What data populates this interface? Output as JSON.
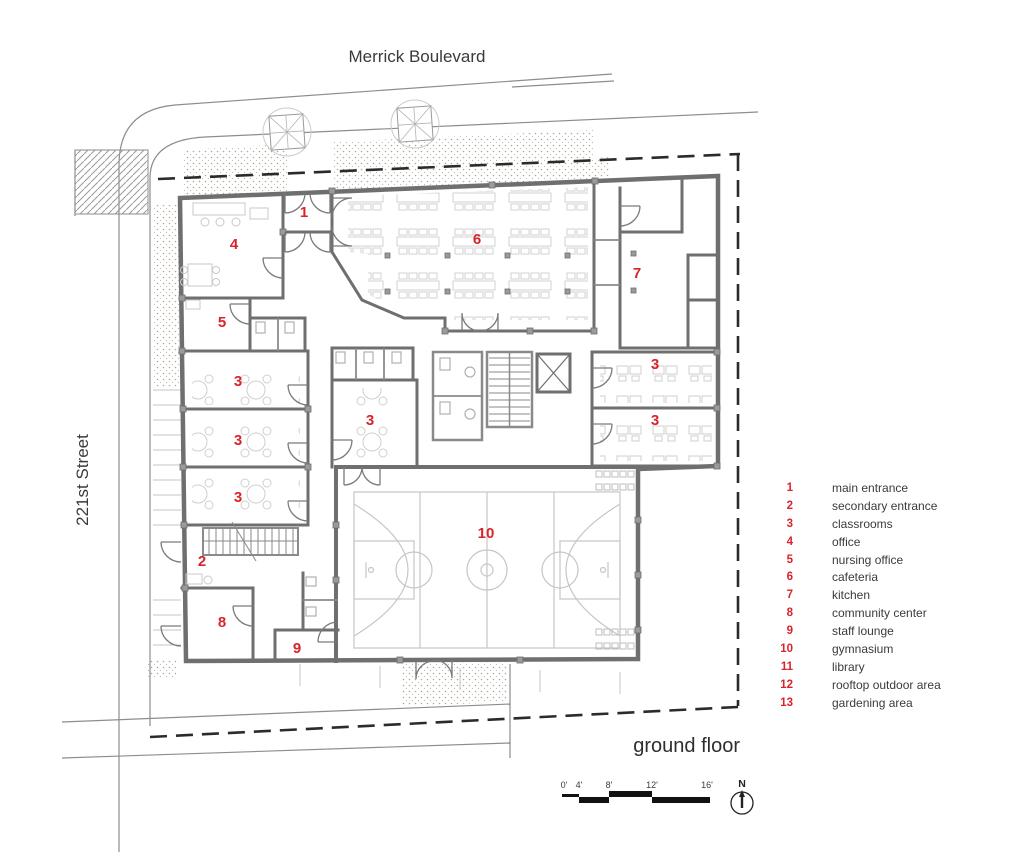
{
  "streets": {
    "top": "Merrick Boulevard",
    "left": "221st Street"
  },
  "title": "ground floor",
  "plan": {
    "labels": [
      {
        "room": "main entrance",
        "num": "1"
      },
      {
        "room": "office",
        "num": "4"
      },
      {
        "room": "nursing office",
        "num": "5"
      },
      {
        "room": "classrooms",
        "num": "3"
      },
      {
        "room": "classrooms",
        "num": "3"
      },
      {
        "room": "classrooms",
        "num": "3"
      },
      {
        "room": "secondary entrance",
        "num": "2"
      },
      {
        "room": "community center",
        "num": "8"
      },
      {
        "room": "staff lounge",
        "num": "9"
      },
      {
        "room": "classrooms",
        "num": "3"
      },
      {
        "room": "cafeteria",
        "num": "6"
      },
      {
        "room": "kitchen",
        "num": "7"
      },
      {
        "room": "classrooms",
        "num": "3"
      },
      {
        "room": "classrooms",
        "num": "3"
      },
      {
        "room": "gymnasium",
        "num": "10"
      }
    ]
  },
  "legend": {
    "items": [
      {
        "num": "1",
        "label": "main entrance"
      },
      {
        "num": "2",
        "label": "secondary entrance"
      },
      {
        "num": "3",
        "label": "classrooms"
      },
      {
        "num": "4",
        "label": "office"
      },
      {
        "num": "5",
        "label": "nursing office"
      },
      {
        "num": "6",
        "label": "cafeteria"
      },
      {
        "num": "7",
        "label": "kitchen"
      },
      {
        "num": "8",
        "label": "community center"
      },
      {
        "num": "9",
        "label": "staff lounge"
      },
      {
        "num": "10",
        "label": "gymnasium"
      },
      {
        "num": "11",
        "label": "library"
      },
      {
        "num": "12",
        "label": "rooftop outdoor area"
      },
      {
        "num": "13",
        "label": "gardening area"
      }
    ]
  },
  "scale_bar": {
    "labels": [
      "0'",
      "4'",
      "8'",
      "12'",
      "16'"
    ]
  },
  "compass": {
    "north_label": "N"
  },
  "colors": {
    "accent_red": "#d9232a",
    "wall_gray": "#6f6f6f",
    "furniture_gray": "#cfcfcf",
    "site_line_gray": "#8d8d8d",
    "court_gray": "#c6c6c6",
    "dashed_black": "#2b2b2b",
    "text_dark": "#3a3a3a"
  }
}
